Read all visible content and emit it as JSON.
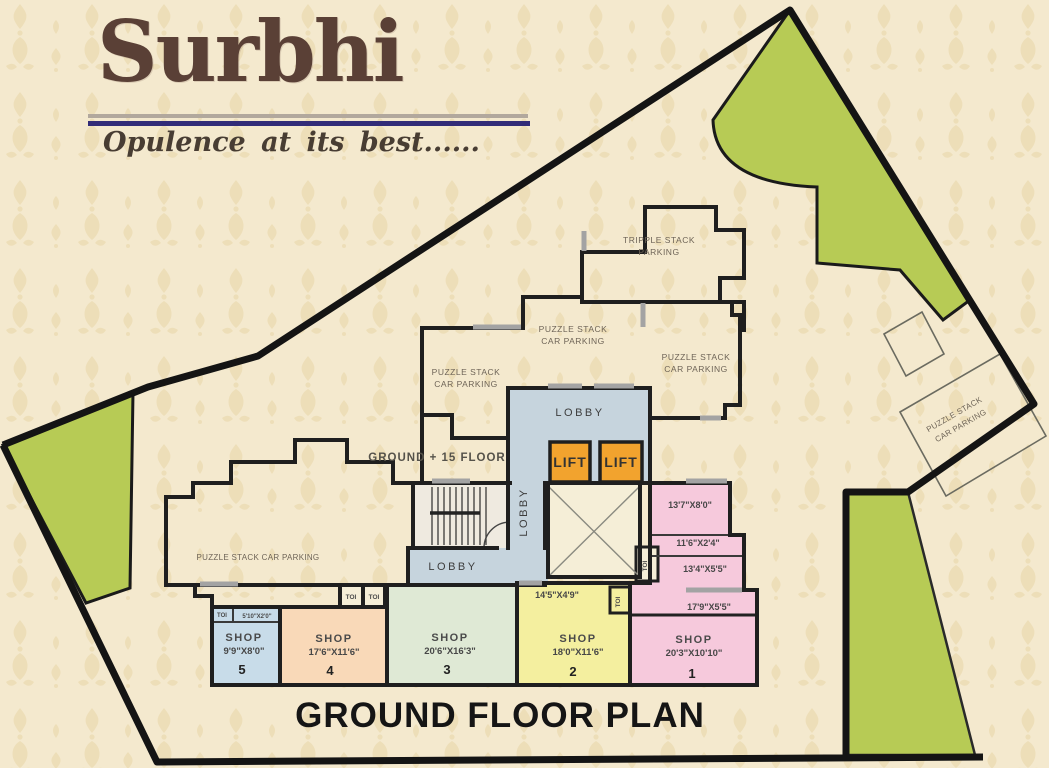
{
  "brand": {
    "name": "Surbhi",
    "tagline": "Opulence  at its best......"
  },
  "plan_title": "GROUND FLOOR PLAN",
  "floor_note": "GROUND + 15 FLOOR",
  "labels": {
    "lobby": "LOBBY",
    "lift": "LIFT",
    "toi": "TOI",
    "tripple_line1": "TRIPPLE STACK",
    "tripple_line2": "PARKING",
    "puzzle_line1": "PUZZLE STACK",
    "puzzle_line2": "CAR PARKING",
    "puzzle_single": "PUZZLE STACK CAR PARKING"
  },
  "dimensions": {
    "room_a": "13'7\"X8'0\"",
    "room_b": "11'6\"X2'4\"",
    "room_c": "13'4\"X5'5\"",
    "room_d": "17'9\"X5'5\"",
    "shop2_entry": "14'5\"X4'9\"",
    "shop5_entry": "5'10\"X2'0\""
  },
  "shops": [
    {
      "label": "SHOP",
      "size": "20'3\"X10'10\"",
      "number": "1"
    },
    {
      "label": "SHOP",
      "size": "18'0\"X11'6\"",
      "number": "2"
    },
    {
      "label": "SHOP",
      "size": "20'6\"X16'3\"",
      "number": "3"
    },
    {
      "label": "SHOP",
      "size": "17'6\"X11'6\"",
      "number": "4"
    },
    {
      "label": "SHOP",
      "size": "9'9\"X8'0\"",
      "number": "5"
    }
  ],
  "colors": {
    "background": "#f4e9ce",
    "pattern": "#e7d4a6",
    "green_area": "#b7cb55",
    "lobby_blue": "#c6d4dd",
    "lift_orange": "#f2a32e",
    "shaft_beige": "#f5eed7",
    "stairs_fill": "#efeae0",
    "shop1_pink": "#f6c9dc",
    "shop2_yellow": "#f4ef9f",
    "shop3_green": "#dfe9d5",
    "shop4_peach": "#f9d9b8",
    "shop5_blue": "#c8dce9",
    "wall": "#1f1f1f",
    "sill_gray": "#a3a3a3",
    "boundary": "#141414"
  }
}
